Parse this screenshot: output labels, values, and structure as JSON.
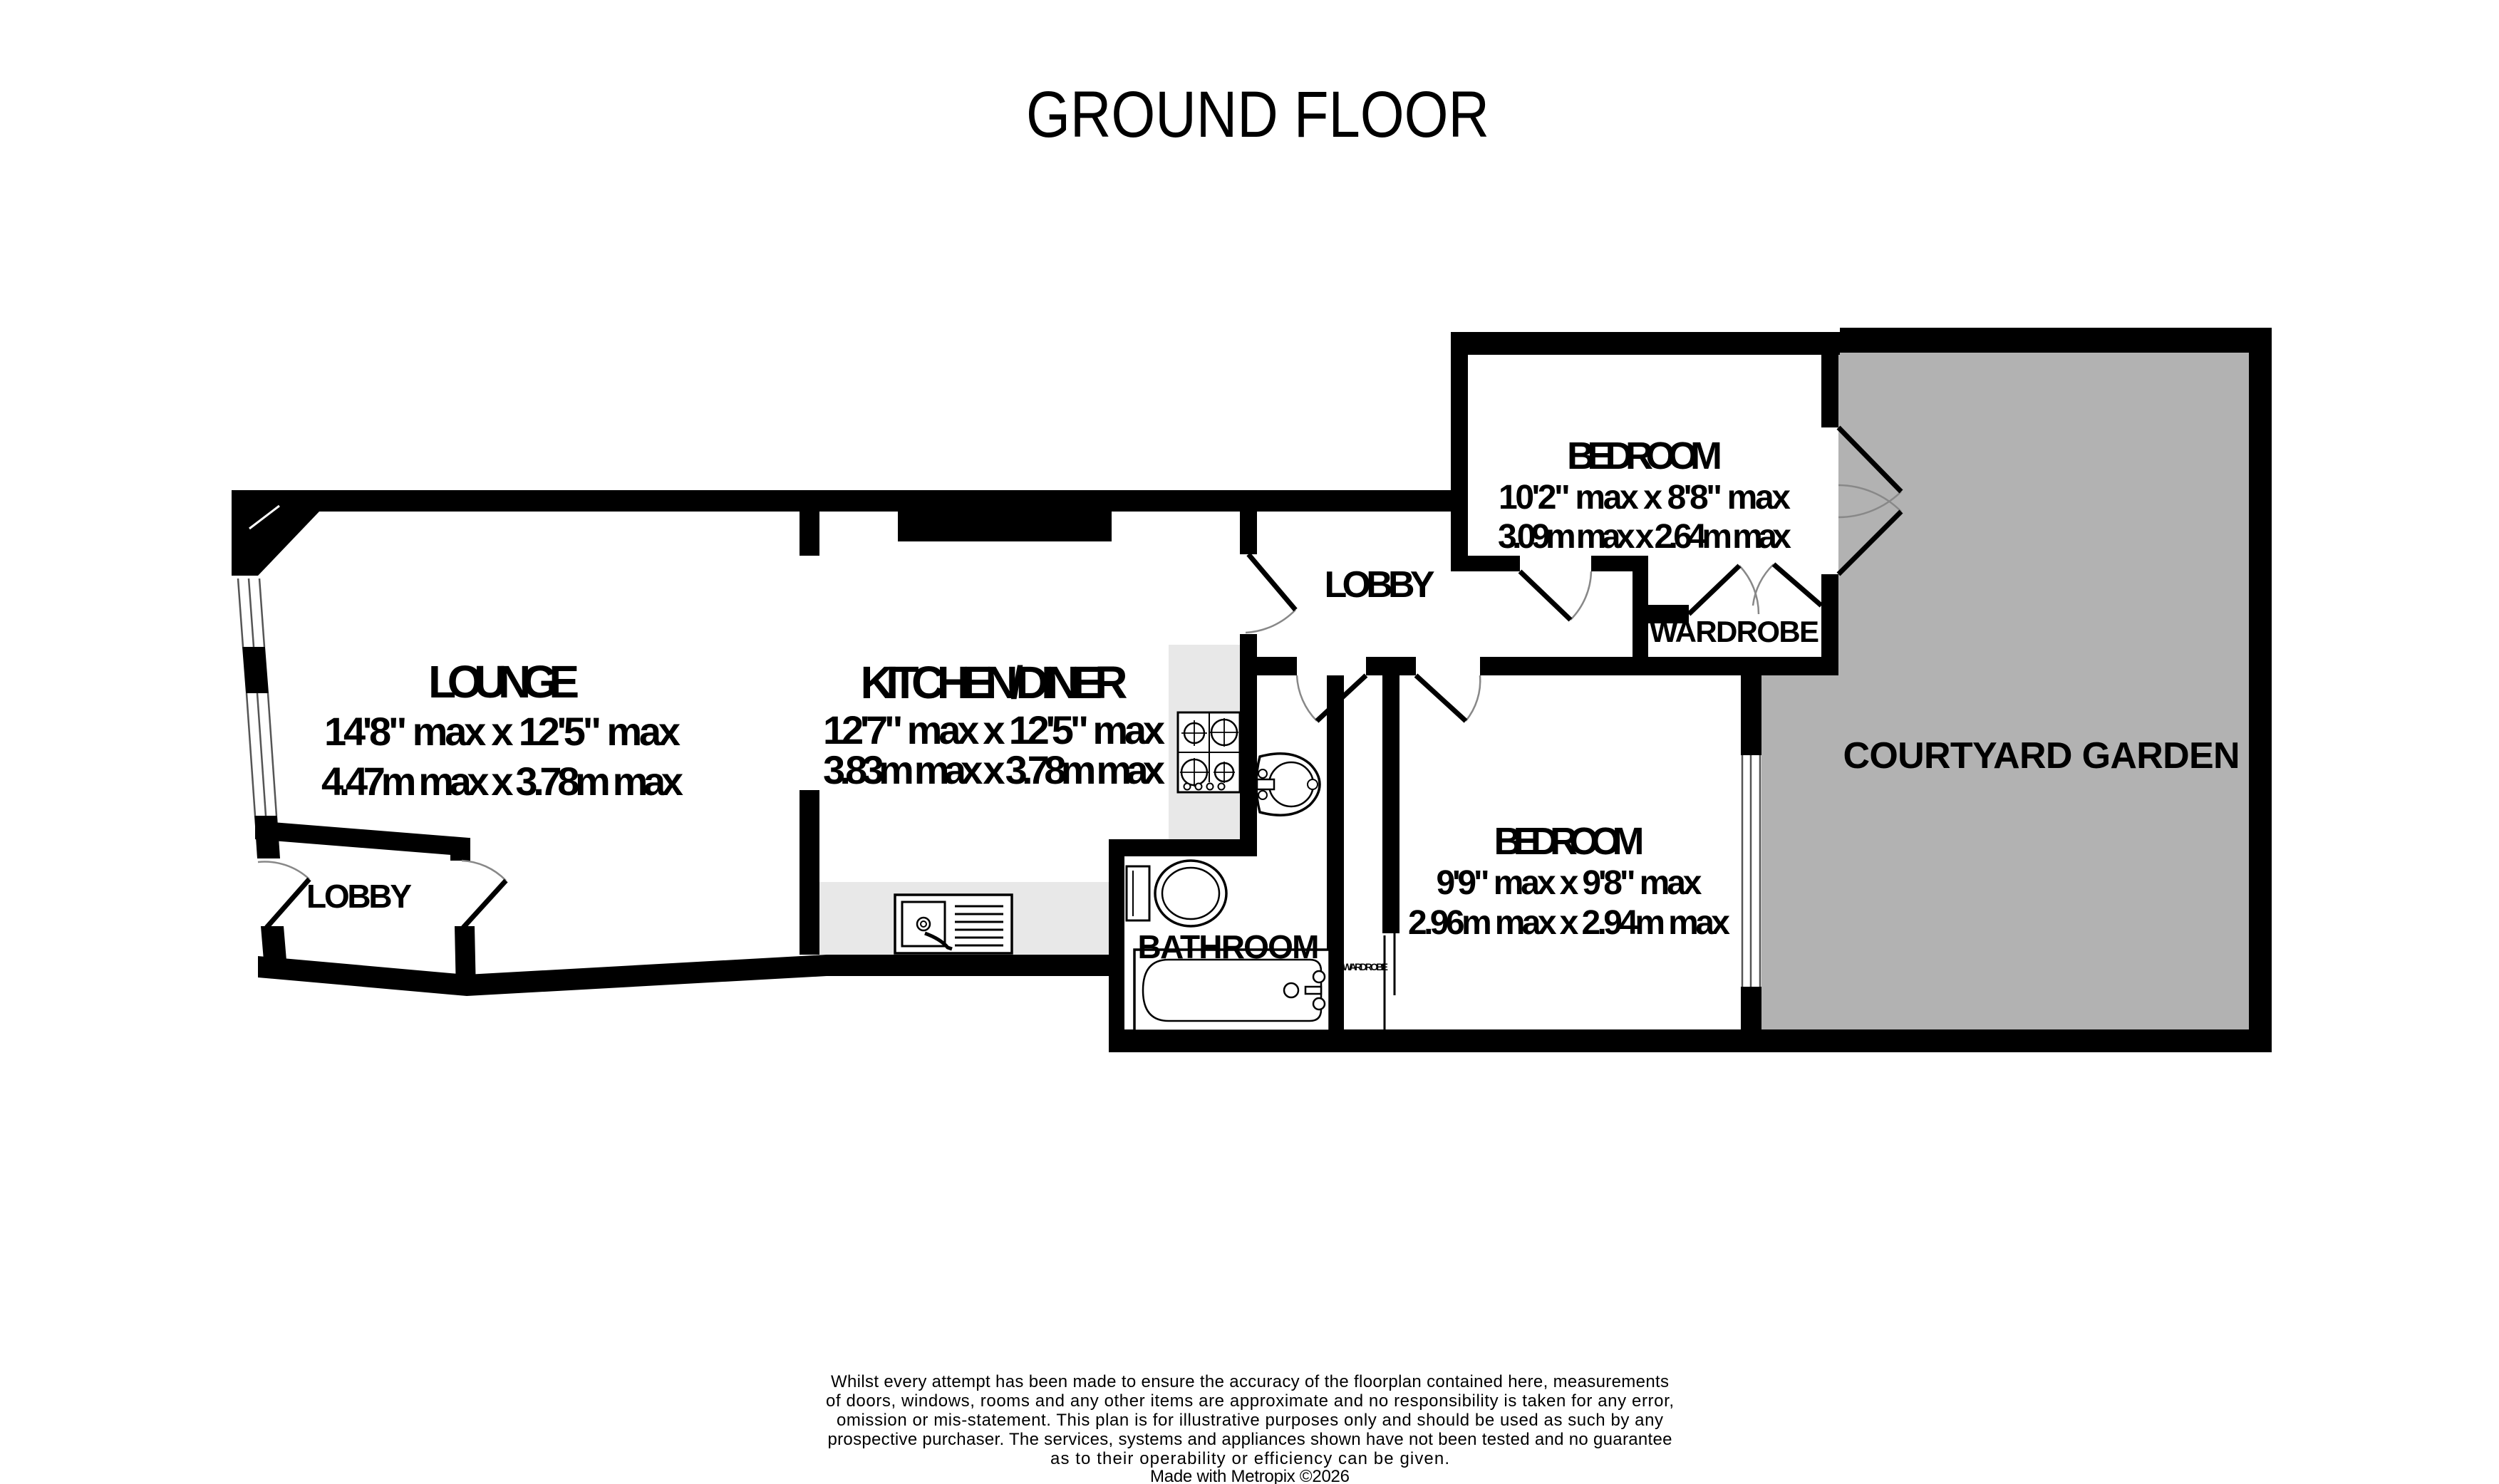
{
  "title": "GROUND FLOOR",
  "colors": {
    "wall": "#000000",
    "courtyard_fill": "#b2b2b2",
    "counter_fill": "#e8e8e8",
    "door_arc": "#888888",
    "window_line": "#555555"
  },
  "rooms": {
    "lounge": {
      "name": "LOUNGE",
      "imperial": "14'8\" max x 12'5\" max",
      "metric": "4.47m max x 3.78m max"
    },
    "kitchen": {
      "name": "KITCHEN/DINER",
      "imperial": "12'7\" max x 12'5\" max",
      "metric": "3.83m max x 3.78m max"
    },
    "bedroom_top": {
      "name": "BEDROOM",
      "imperial": "10'2\" max x 8'8\" max",
      "metric": "3.09m max x 2.64m max"
    },
    "bedroom_bottom": {
      "name": "BEDROOM",
      "imperial": "9'9\" max x 9'8\" max",
      "metric": "2.96m max x 2.94m max"
    },
    "lobby_center": {
      "name": "LOBBY"
    },
    "lobby_left": {
      "name": "LOBBY"
    },
    "bathroom": {
      "name": "BATHROOM"
    },
    "wardrobe": {
      "name": "WARDROBE"
    },
    "wardrobe_small": {
      "name": "WARDROBE"
    },
    "courtyard": {
      "name": "COURTYARD GARDEN"
    }
  },
  "disclaimer": {
    "lines": [
      "Whilst every attempt has been made to ensure the accuracy of the floorplan contained here, measurements",
      "of doors, windows, rooms and any other items are approximate and no responsibility is taken for any error,",
      "omission or mis-statement. This plan is for illustrative purposes only and should be used as such by any",
      "prospective purchaser. The services, systems and appliances shown have not been tested and no guarantee",
      "as to their operability or efficiency can be given.",
      "Made with Metropix ©2026"
    ]
  }
}
